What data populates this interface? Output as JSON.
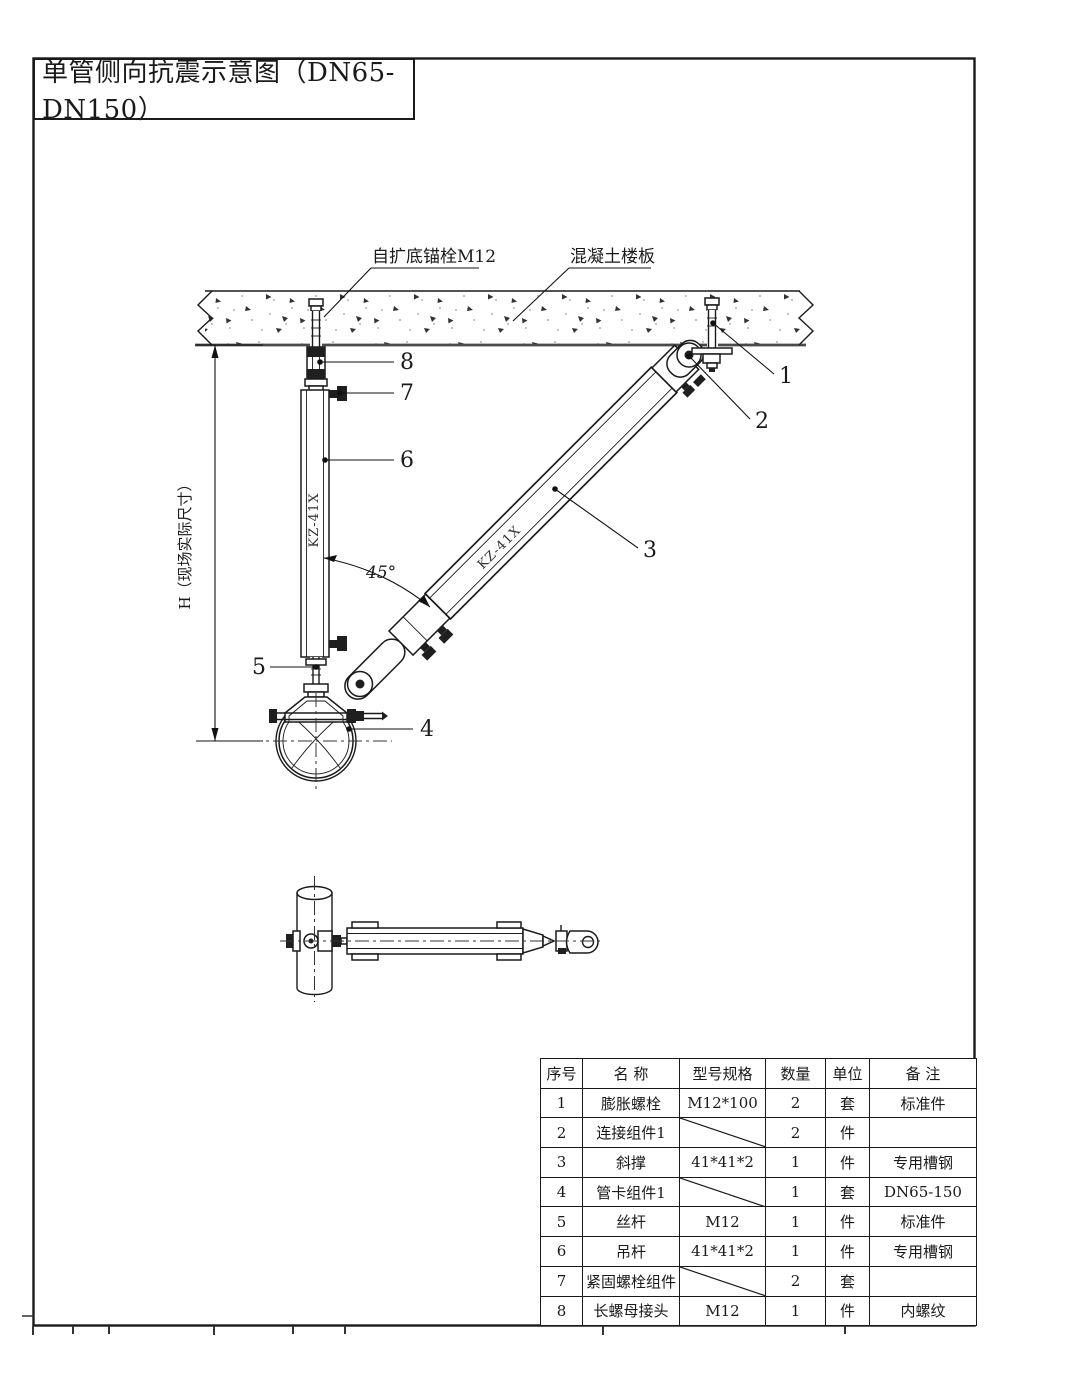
{
  "page": {
    "background": "#ffffff",
    "line_color": "#1a1a1a"
  },
  "title": "单管侧向抗震示意图（DN65-DN150）",
  "drawing": {
    "anchor_label": "自扩底锚栓M12",
    "slab_label": "混凝土楼板",
    "dim_label": "H（现场实际尺寸）",
    "angle_label": "45°",
    "hanger_mark": "KZ-41X",
    "brace_mark": "KZ-41X",
    "callouts": {
      "c1": "1",
      "c2": "2",
      "c3": "3",
      "c4": "4",
      "c5": "5",
      "c6": "6",
      "c7": "7",
      "c8": "8"
    }
  },
  "table": {
    "headers": [
      "序号",
      "名 称",
      "型号规格",
      "数量",
      "单位",
      "备 注"
    ],
    "rows": [
      {
        "num": "1",
        "name": "膨胀螺栓",
        "spec": "M12*100",
        "qty": "2",
        "unit": "套",
        "note": "标准件"
      },
      {
        "num": "2",
        "name": "连接组件1",
        "spec": "",
        "qty": "2",
        "unit": "件",
        "note": ""
      },
      {
        "num": "3",
        "name": "斜撑",
        "spec": "41*41*2",
        "qty": "1",
        "unit": "件",
        "note": "专用槽钢"
      },
      {
        "num": "4",
        "name": "管卡组件1",
        "spec": "",
        "qty": "1",
        "unit": "套",
        "note": "DN65-150"
      },
      {
        "num": "5",
        "name": "丝杆",
        "spec": "M12",
        "qty": "1",
        "unit": "件",
        "note": "标准件"
      },
      {
        "num": "6",
        "name": "吊杆",
        "spec": "41*41*2",
        "qty": "1",
        "unit": "件",
        "note": "专用槽钢"
      },
      {
        "num": "7",
        "name": "紧固螺栓组件",
        "spec": "",
        "qty": "2",
        "unit": "套",
        "note": ""
      },
      {
        "num": "8",
        "name": "长螺母接头",
        "spec": "M12",
        "qty": "1",
        "unit": "件",
        "note": "内螺纹"
      }
    ]
  }
}
